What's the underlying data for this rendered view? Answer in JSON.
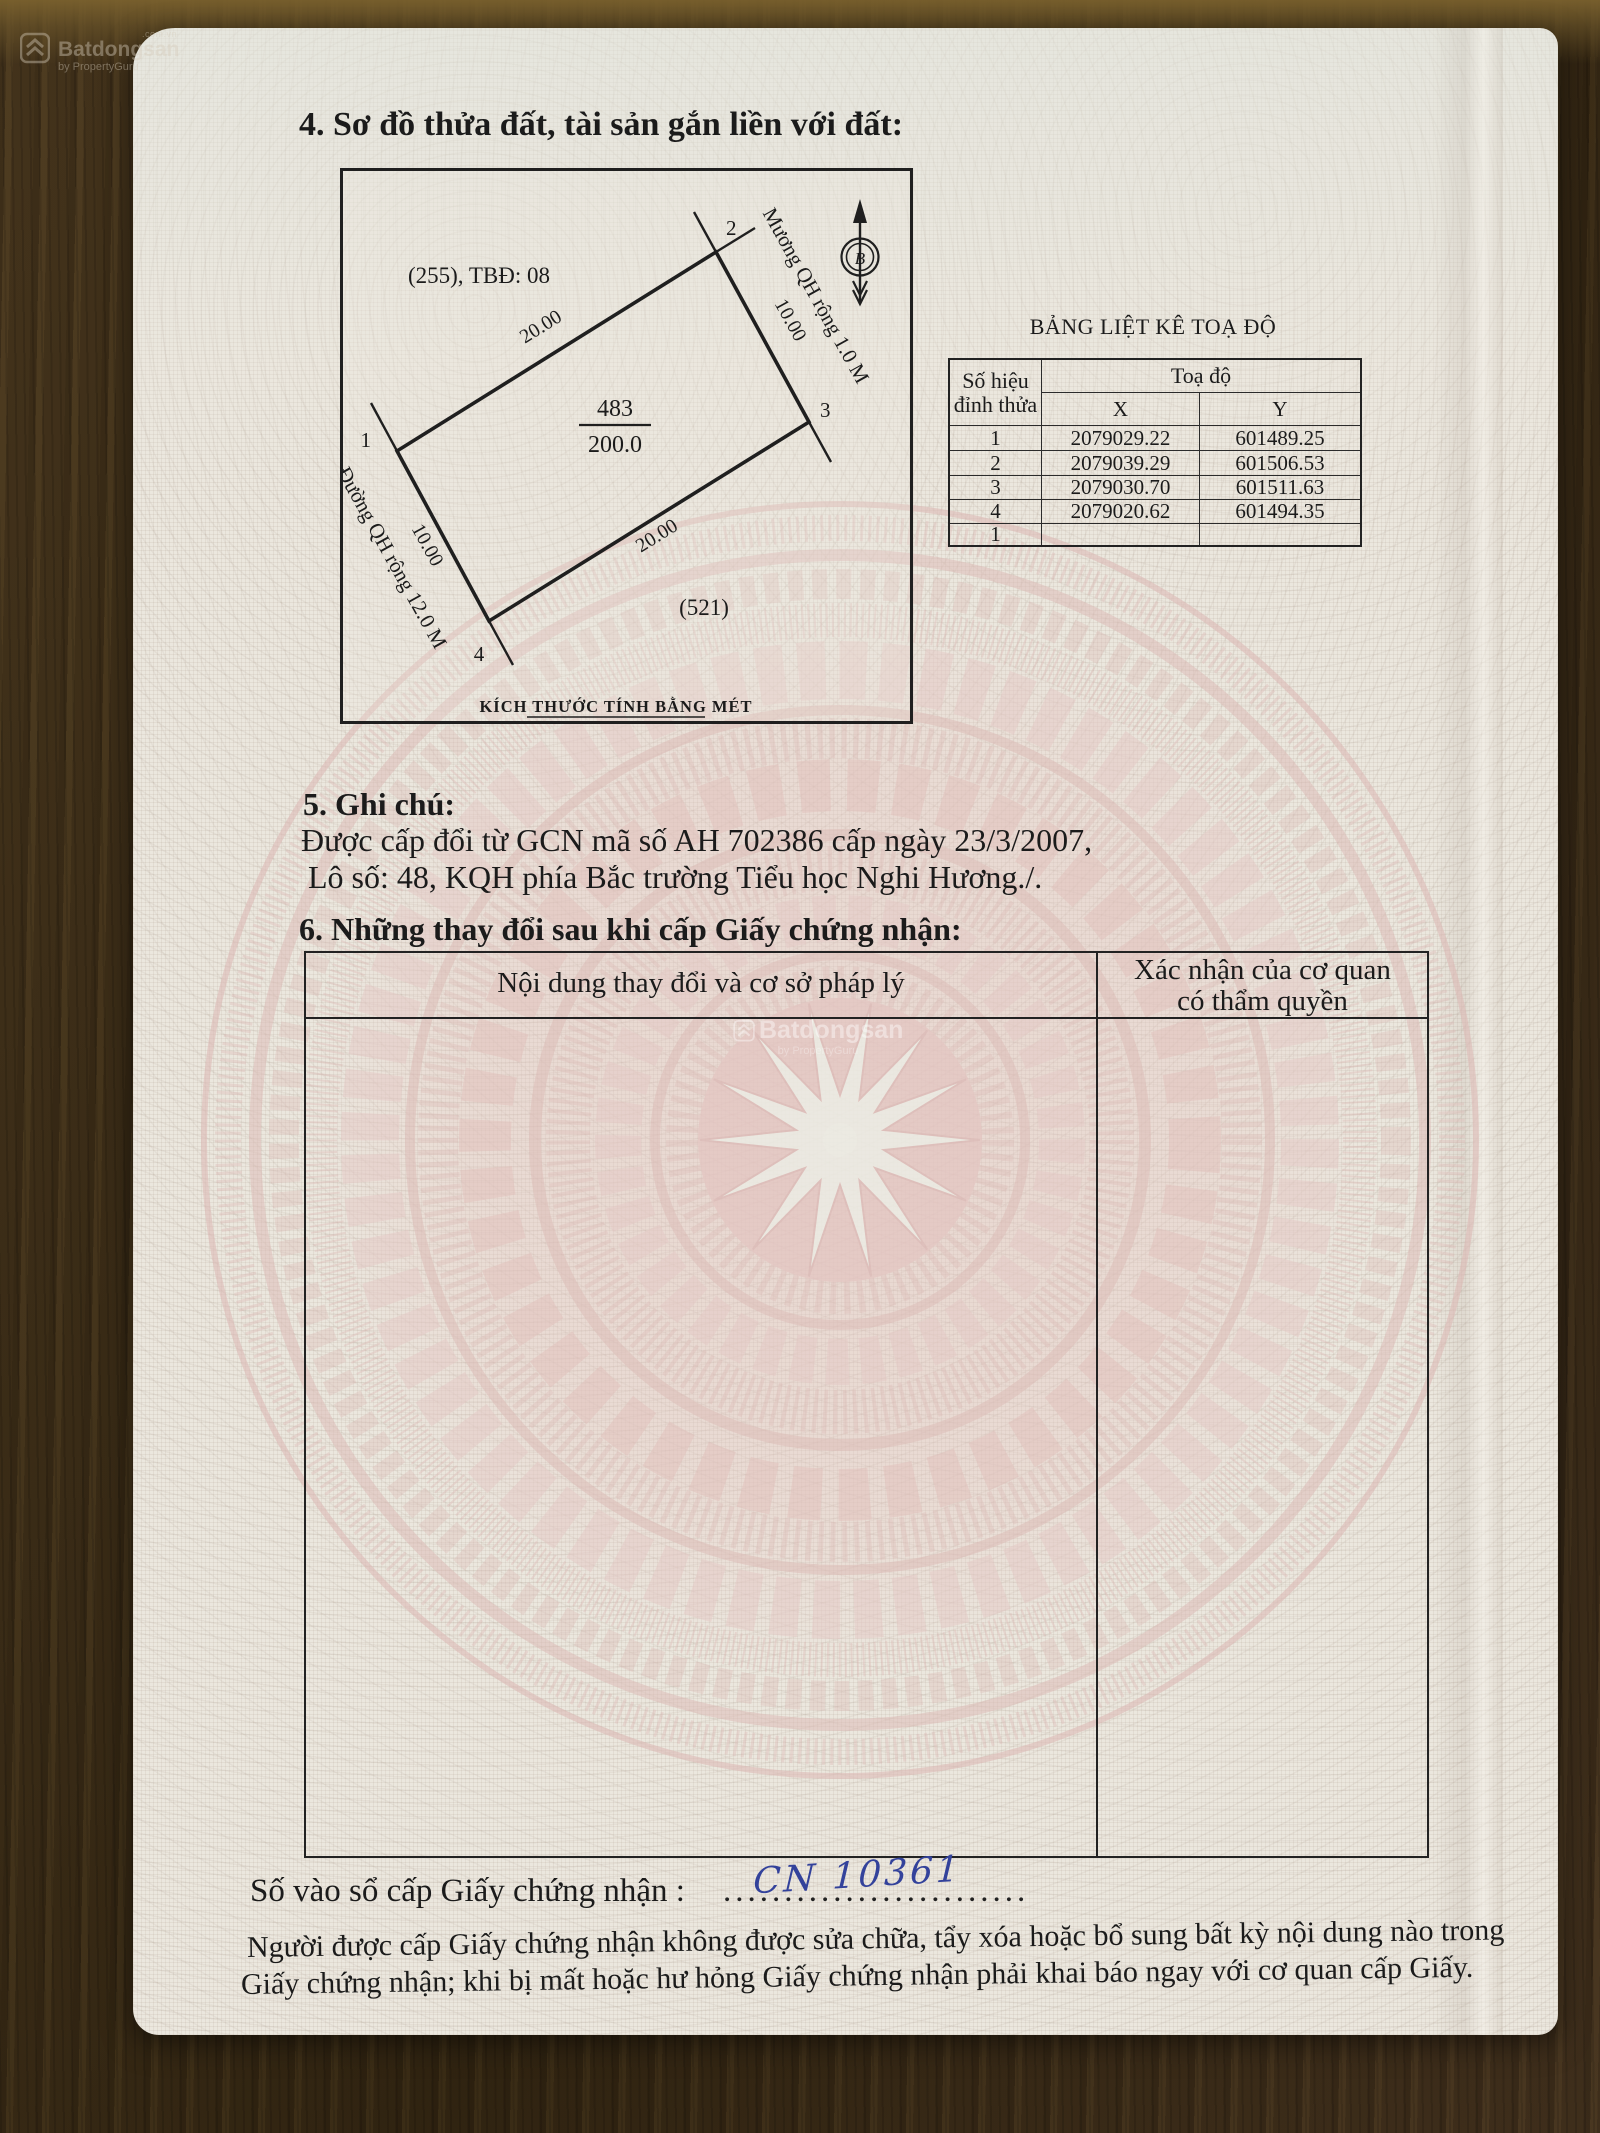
{
  "watermark_top": {
    "brand": "Batdongsan",
    "domain": ".com.vn",
    "byline": "by PropertyGuru"
  },
  "watermark_center": {
    "brand": "Batdongsan",
    "byline": "by PropertyGuru"
  },
  "section4": {
    "heading": "4. Sơ đồ thửa đất, tài sản gắn liền với đất:",
    "plot": {
      "map_sheet_label": "(255), TBĐ: 08",
      "parcel_number": "483",
      "parcel_area": "200.0",
      "neighbor_label": "(521)",
      "road_label": "Đường QH rộng 12.0 M",
      "canal_label": "Mương QH rộng 1.0 M",
      "north_letter": "B",
      "scale_note": "KÍCH THƯỚC TÍNH BẰNG MÉT",
      "vertex_labels": {
        "v1": "1",
        "v2": "2",
        "v3": "3",
        "v4": "4"
      },
      "edge_labels": {
        "e12": "20.00",
        "e23": "10.00",
        "e43": "20.00",
        "e14": "10.00"
      }
    }
  },
  "coord_table": {
    "title": "BẢNG LIỆT KÊ TOẠ ĐỘ",
    "corner_header_line1": "Số hiệu",
    "corner_header_line2": "đỉnh thửa",
    "group_header": "Toạ độ",
    "col_x": "X",
    "col_y": "Y",
    "rows": [
      {
        "id": "1",
        "x": "2079029.22",
        "y": "601489.25"
      },
      {
        "id": "2",
        "x": "2079039.29",
        "y": "601506.53"
      },
      {
        "id": "3",
        "x": "2079030.70",
        "y": "601511.63"
      },
      {
        "id": "4",
        "x": "2079020.62",
        "y": "601494.35"
      },
      {
        "id": "1",
        "x": "",
        "y": ""
      }
    ]
  },
  "section5": {
    "heading": "5. Ghi chú:",
    "line1": "Được cấp đổi từ GCN mã số AH 702386 cấp ngày 23/3/2007,",
    "line2": "Lô số: 48, KQH phía Bắc trường Tiểu học Nghi Hương./."
  },
  "section6": {
    "heading": "6. Những thay đổi sau khi cấp Giấy chứng nhận:",
    "col1_header": "Nội dung thay đổi và cơ sở pháp lý",
    "col2_header_line1": "Xác nhận của cơ quan",
    "col2_header_line2": "có thẩm quyền"
  },
  "footer": {
    "serial_label": "Số vào sổ cấp Giấy chứng nhận :",
    "serial_dots": ".........................",
    "serial_value": "CN 10361",
    "note_line1": "Người được cấp Giấy chứng nhận không được sửa chữa, tẩy xóa hoặc bổ sung bất kỳ nội dung nào trong",
    "note_line2": "Giấy chứng nhận; khi bị mất hoặc hư hỏng Giấy chứng nhận phải khai báo ngay với cơ quan cấp Giấy."
  },
  "colors": {
    "ink": "#1b1b1b",
    "handwriting_blue": "#33429b",
    "drum_pink": "#ddbcb8",
    "paper": "#ebe7de",
    "wood": "#3b2d18"
  }
}
